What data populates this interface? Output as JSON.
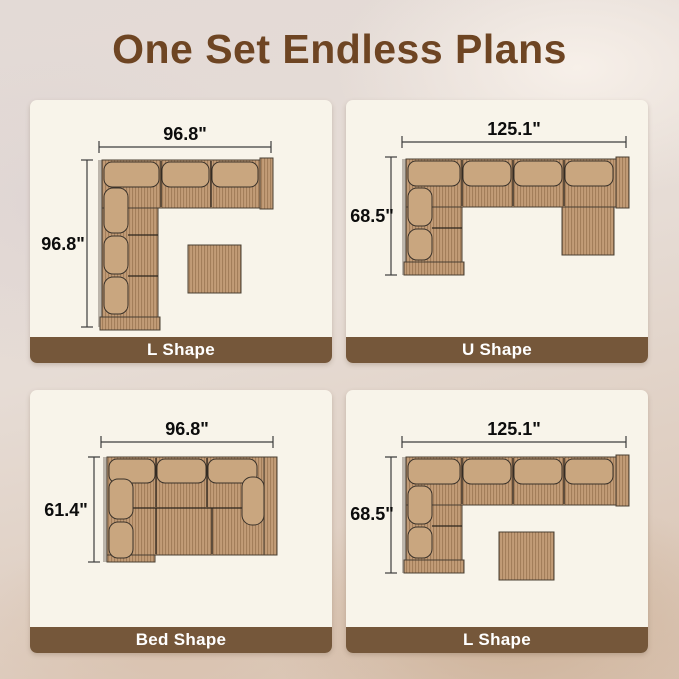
{
  "title": "One Set Endless Plans",
  "colors": {
    "title_brown": "#6E4523",
    "label_bar_brown": "#75573A",
    "panel_background": "#F8F4EA",
    "sofa_tan": "#C29C77",
    "sofa_stripe": "#A37E5A",
    "cushion_tan": "#C9A67F"
  },
  "panels": [
    {
      "label": "L Shape",
      "width_label": "96.8\"",
      "height_label": "96.8\""
    },
    {
      "label": "U Shape",
      "width_label": "125.1\"",
      "height_label": "68.5\""
    },
    {
      "label": "Bed Shape",
      "width_label": "96.8\"",
      "height_label": "61.4\""
    },
    {
      "label": "L Shape",
      "width_label": "125.1\"",
      "height_label": "68.5\""
    }
  ]
}
